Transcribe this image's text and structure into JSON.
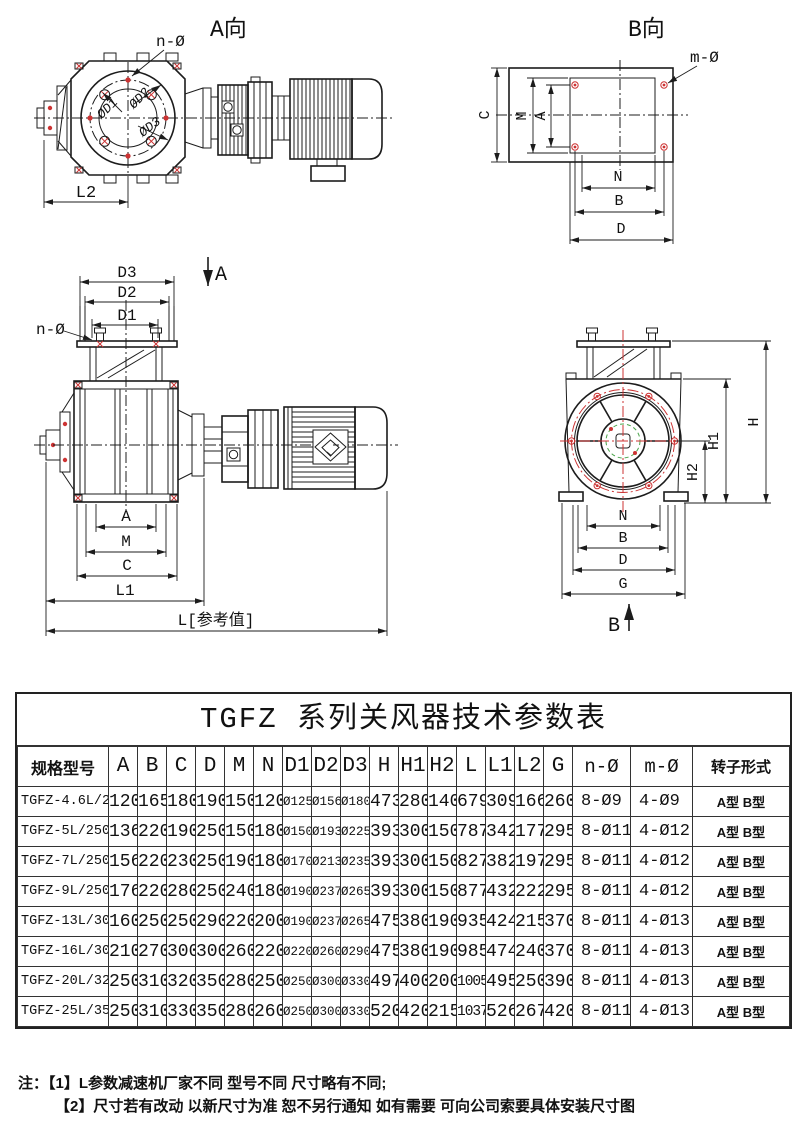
{
  "drawings": {
    "view_a": {
      "title": "A向",
      "hole_callout": "n-Ø",
      "dia1": "ØD1",
      "dia2": "ØD2",
      "dia3": "ØD3",
      "dim_l2": "L2"
    },
    "view_b": {
      "title": "B向",
      "hole_callout": "m-Ø",
      "dim_c": "C",
      "dim_m": "M",
      "dim_a": "A",
      "dim_n": "N",
      "dim_b": "B",
      "dim_d": "D"
    },
    "front_view": {
      "dim_d3": "D3",
      "dim_d2": "D2",
      "dim_d1": "D1",
      "hole_callout": "n-Ø",
      "section_mark": "A",
      "dim_a": "A",
      "dim_m": "M",
      "dim_c": "C",
      "dim_l1": "L1",
      "dim_l": "L[参考值]"
    },
    "end_view": {
      "dim_h": "H",
      "dim_h1": "H1",
      "dim_h2": "H2",
      "dim_n": "N",
      "dim_b": "B",
      "dim_d": "D",
      "dim_g": "G",
      "section_mark": "B"
    }
  },
  "table": {
    "title": "TGFZ 系列关风器技术参数表",
    "headers": [
      "规格型号",
      "A",
      "B",
      "C",
      "D",
      "M",
      "N",
      "D1",
      "D2",
      "D3",
      "H",
      "H1",
      "H2",
      "L",
      "L1",
      "L2",
      "G",
      "n-Ø",
      "m-Ø",
      "转子形式"
    ],
    "rows": [
      [
        "TGFZ-4.6L/210",
        "120",
        "165",
        "180",
        "190",
        "150",
        "120",
        "Ø125",
        "Ø156",
        "Ø180",
        "473",
        "280",
        "140",
        "679",
        "309",
        "166",
        "260",
        "8-Ø9",
        "4-Ø9",
        "A型 B型"
      ],
      [
        "TGFZ-5L/250",
        "136",
        "220",
        "190",
        "250",
        "150",
        "180",
        "Ø150",
        "Ø193",
        "Ø225",
        "393",
        "300",
        "150",
        "787",
        "342",
        "177",
        "295",
        "8-Ø11",
        "4-Ø12",
        "A型 B型"
      ],
      [
        "TGFZ-7L/250",
        "156",
        "220",
        "230",
        "250",
        "190",
        "180",
        "Ø170",
        "Ø213",
        "Ø235",
        "393",
        "300",
        "150",
        "827",
        "382",
        "197",
        "295",
        "8-Ø11",
        "4-Ø12",
        "A型 B型"
      ],
      [
        "TGFZ-9L/250",
        "176",
        "220",
        "280",
        "250",
        "240",
        "180",
        "Ø190",
        "Ø237",
        "Ø265",
        "393",
        "300",
        "150",
        "877",
        "432",
        "222",
        "295",
        "8-Ø11",
        "4-Ø12",
        "A型 B型"
      ],
      [
        "TGFZ-13L/300",
        "160",
        "250",
        "250",
        "290",
        "220",
        "200",
        "Ø190",
        "Ø237",
        "Ø265",
        "475",
        "380",
        "190",
        "935",
        "424",
        "215",
        "370",
        "8-Ø11",
        "4-Ø13",
        "A型 B型"
      ],
      [
        "TGFZ-16L/300",
        "210",
        "270",
        "300",
        "300",
        "260",
        "220",
        "Ø220",
        "Ø260",
        "Ø290",
        "475",
        "380",
        "190",
        "985",
        "474",
        "240",
        "370",
        "8-Ø11",
        "4-Ø13",
        "A型 B型"
      ],
      [
        "TGFZ-20L/320",
        "250",
        "310",
        "320",
        "350",
        "280",
        "250",
        "Ø250",
        "Ø300",
        "Ø330",
        "497",
        "400",
        "200",
        "1005",
        "495",
        "250",
        "390",
        "8-Ø11",
        "4-Ø13",
        "A型 B型"
      ],
      [
        "TGFZ-25L/350",
        "250",
        "310",
        "330",
        "350",
        "280",
        "260",
        "Ø250",
        "Ø300",
        "Ø330",
        "520",
        "420",
        "215",
        "1037",
        "526",
        "267",
        "420",
        "8-Ø11",
        "4-Ø13",
        "A型 B型"
      ]
    ]
  },
  "notes": {
    "prefix": "注：",
    "line1": "【1】L参数减速机厂家不同 型号不同 尺寸略有不同;",
    "line2": "【2】尺寸若有改动 以新尺寸为准 恕不另行通知 如有需要 可向公司索要具体安装尺寸图"
  }
}
